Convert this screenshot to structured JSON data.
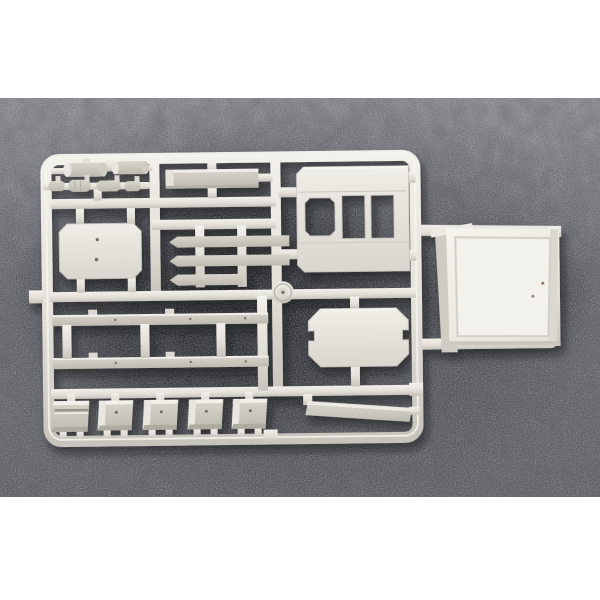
{
  "meta": {
    "description": "Product photograph of an unpainted light-grey injection-moulded plastic model kit sprue (parts tree) lying on a dark speckled grey felt backdrop, with a separate large cab body shell resting loose at the right edge of the sprue. White margins above and below the photo.",
    "subject": "plastic model kit sprue",
    "text_content": "none visible"
  },
  "colors": {
    "page_bg": "#ffffff",
    "backdrop_top": "#85878c",
    "backdrop_mid": "#64666b",
    "backdrop_bottom": "#5a5c61",
    "backdrop_shadow": "#14161a",
    "plastic_highlight": "#f2f0ea",
    "plastic": "#e3e0d9",
    "plastic_shadow": "#c7c4bc",
    "part_face": "#d8d5cc",
    "part_face_dark": "#bdbab0",
    "mark_dot": "#6b6860",
    "pin_mark": "#8a6f5f"
  },
  "photo": {
    "top_margin_px": 98,
    "photo_height_px": 399,
    "bottom_margin_px": 103,
    "backdrop_texture": "speckled felt"
  },
  "sprue": {
    "material": "light grey styrene",
    "parts": [
      {
        "name": "cylindrical tank",
        "count": 2
      },
      {
        "name": "segmented exhaust rod",
        "count": 1
      },
      {
        "name": "long rectangular plate",
        "count": 1
      },
      {
        "name": "panel with three window cutouts",
        "count": 1
      },
      {
        "name": "rounded door panel with two ejector marks",
        "count": 1
      },
      {
        "name": "tapered cross bar",
        "count": 3
      },
      {
        "name": "chassis side rail",
        "count": 2
      },
      {
        "name": "octagonal hatch panel with edge notches",
        "count": 1
      },
      {
        "name": "curved fender segment",
        "count": 5
      },
      {
        "name": "long side skirt bar",
        "count": 1
      },
      {
        "name": "injection gate hub",
        "count": 1
      },
      {
        "name": "cab body shell resting off-sprue",
        "count": 1
      }
    ]
  }
}
